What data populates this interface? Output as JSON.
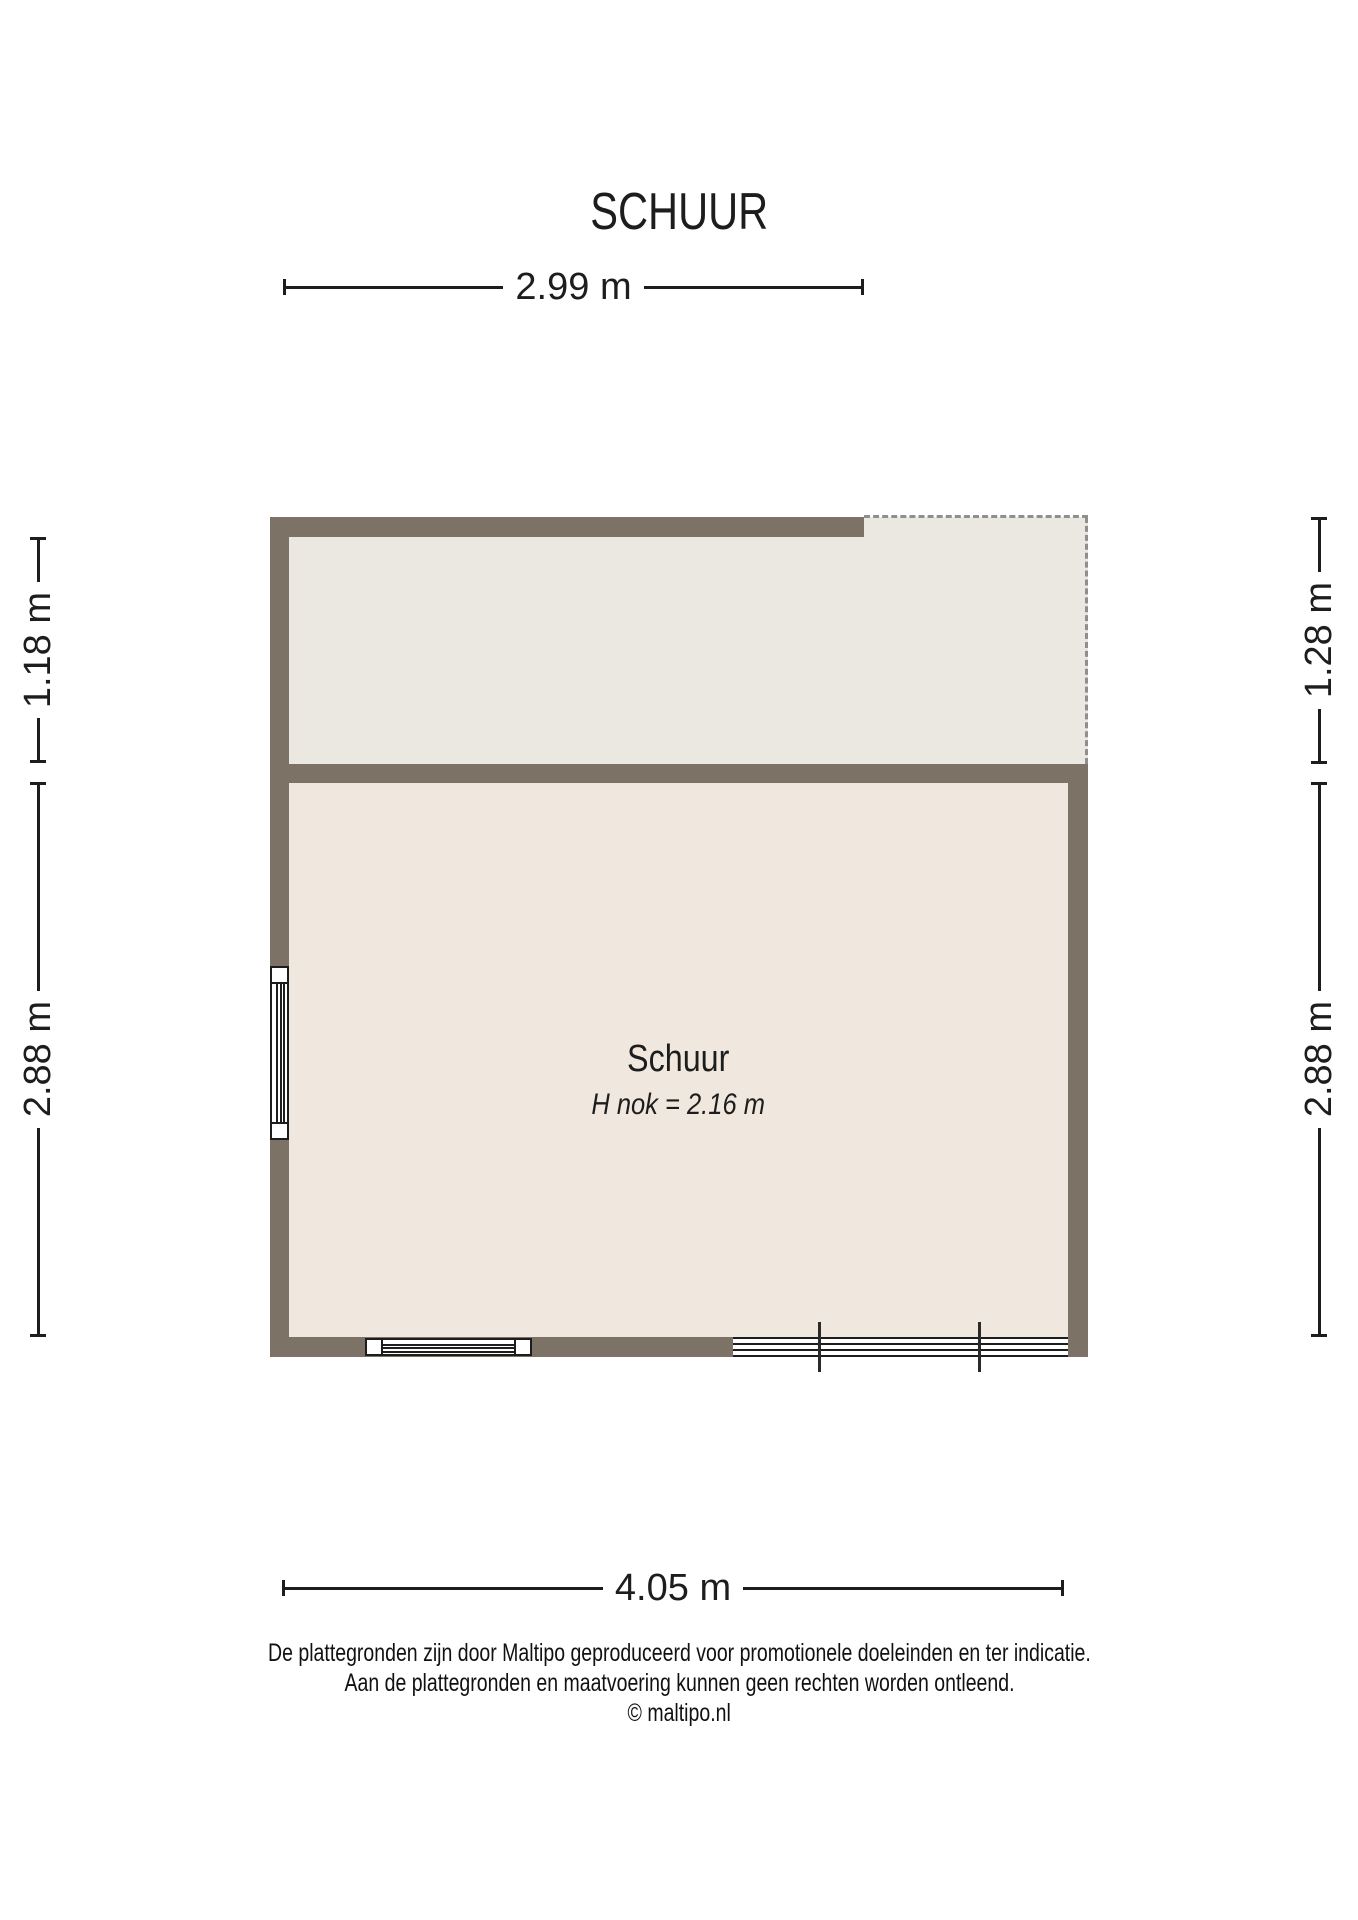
{
  "title": "SCHUUR",
  "room": {
    "name": "Schuur",
    "height_note": "H nok = 2.16 m"
  },
  "dimensions": {
    "top_width": "2.99 m",
    "bottom_width": "4.05 m",
    "left_upper": "1.18 m",
    "left_lower": "2.88 m",
    "right_upper": "1.28 m",
    "right_lower": "2.88 m"
  },
  "footer": {
    "disclaimer_line1": "De plattegronden zijn door Maltipo geproduceerd voor promotionele doeleinden en ter indicatie.",
    "disclaimer_line2": "Aan de plattegronden en maatvoering kunnen geen rechten worden ontleend.",
    "copyright": "© maltipo.nl"
  },
  "colors": {
    "wall": "#7d7266",
    "floor_storage": "#eae8e0",
    "floor_room": "#f0e8de",
    "dash": "#8f8f8f",
    "line": "#1d1d1d"
  }
}
